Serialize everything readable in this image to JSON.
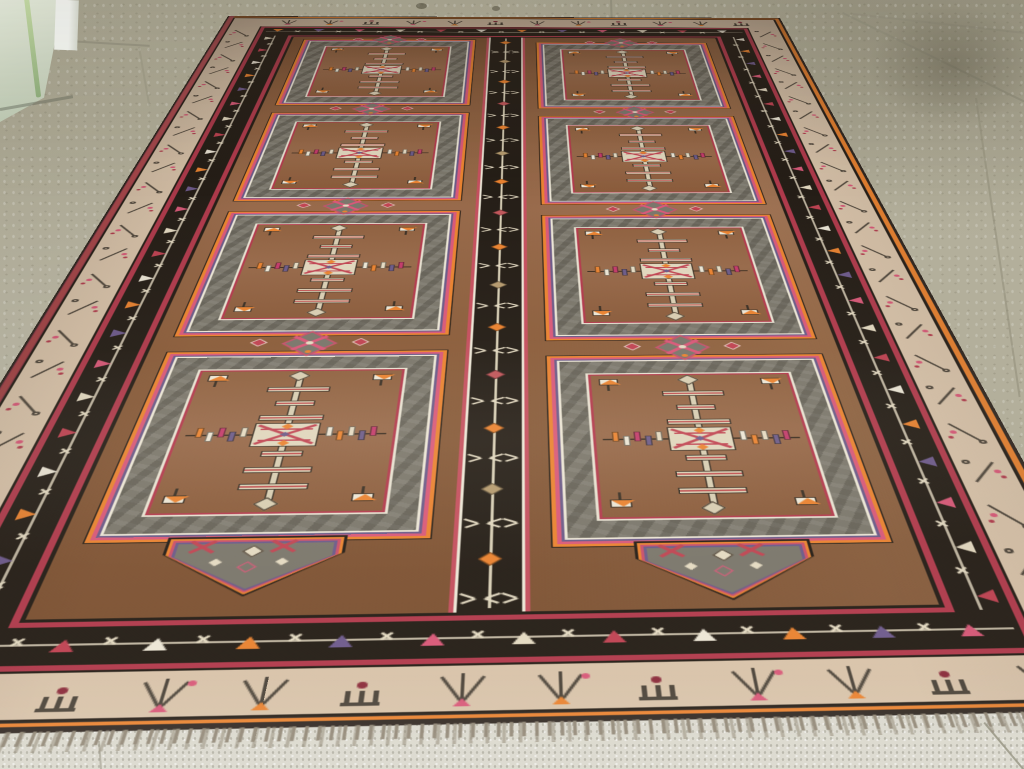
{
  "scene": {
    "type": "photograph",
    "subject": "vintage Turkish Kars gallery carpet displayed on a speckled tile showroom floor",
    "viewpoint": "standing view looking down the length of the carpet toward a glass partition corner",
    "elements": [
      "tile floor",
      "glass partition corner",
      "carpet with two columns of four compartments",
      "central black guard stripe",
      "bottom fringe"
    ]
  },
  "palette": {
    "floor": "#b3af9b",
    "floor_strip": "#dbd9ce",
    "floor_grout": "#8f8c79",
    "glass_green": "#a9c98e",
    "glass_pale": "#e4ecdb",
    "glass_post": "#f3f5f0",
    "field_brown": "#8a5c3a",
    "field_brown_light": "#a37950",
    "field_brown_dark": "#66432a",
    "panel_gray": "#7a766b",
    "panel_gray_dark": "#555146",
    "black_band": "#241d16",
    "outline_dark": "#2f2620",
    "cream_band": "#d8c3aa",
    "cream_motif": "#e4dac2",
    "vine_dark": "#4a4238",
    "red": "#b13a4c",
    "pink": "#d85878",
    "magenta": "#c23a6a",
    "salmon": "#c44f5e",
    "orange": "#e98230",
    "purple": "#6b5a88",
    "white": "#ebe5d5",
    "tan": "#b59a6e",
    "maroon": "#8a2a3a",
    "fringe": "#8e8473"
  },
  "rug": {
    "layout": "two columns of four joined compartment panels divided by a black reciprocal stripe",
    "compartments": 8,
    "tick_colors": [
      "#e98230",
      "#ebe5d5",
      "#c23a6a",
      "#6b5a88",
      "#e4dac2"
    ],
    "triangle_cycle": [
      "#e4dac2",
      "#c04252",
      "#ece6d6",
      "#e98230",
      "#6d5a8c",
      "#d85878"
    ],
    "stripe_diamond_cycle": [
      "#e98230",
      "#b59a6e",
      "#e98230",
      "#c0565a"
    ],
    "bar_widths": [
      48,
      30,
      48
    ],
    "stem_bars_above": 3,
    "stem_bars_below": 3
  },
  "floor": {
    "material": "speckled terrazzo tile",
    "grout_lines": 8,
    "stains": 5
  }
}
